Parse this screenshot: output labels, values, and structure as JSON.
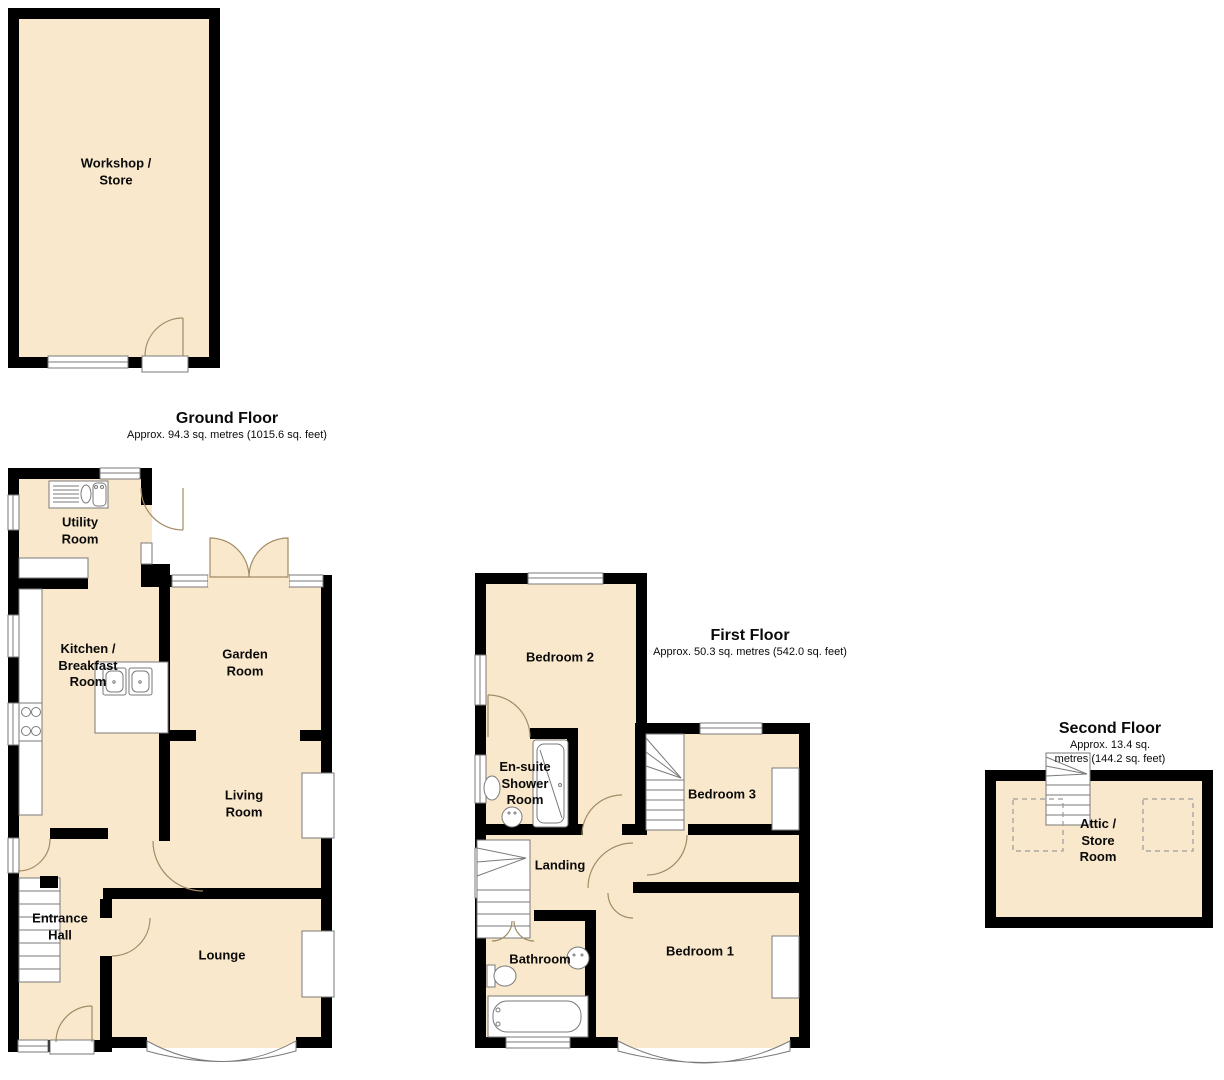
{
  "colors": {
    "room_fill": "#fae8cc",
    "wall": "#000000",
    "door_arc": "#a18c66",
    "fixture_line": "#7a7a7a",
    "dashed_line": "#9a9a9a",
    "label_color": "#0a0a0a"
  },
  "floors": [
    {
      "id": "ground",
      "title": "Ground Floor",
      "area": "Approx. 94.3 sq. metres (1015.6 sq. feet)",
      "rooms": [
        {
          "name": "Workshop /\nStore"
        },
        {
          "name": "Utility\nRoom"
        },
        {
          "name": "Kitchen /\nBreakfast\nRoom"
        },
        {
          "name": "Garden\nRoom"
        },
        {
          "name": "Living\nRoom"
        },
        {
          "name": "Entrance\nHall"
        },
        {
          "name": "Lounge"
        }
      ]
    },
    {
      "id": "first",
      "title": "First Floor",
      "area": "Approx. 50.3 sq. metres (542.0 sq. feet)",
      "rooms": [
        {
          "name": "Bedroom 2"
        },
        {
          "name": "En-suite\nShower\nRoom"
        },
        {
          "name": "Landing"
        },
        {
          "name": "Bedroom 3"
        },
        {
          "name": "Bathroom"
        },
        {
          "name": "Bedroom 1"
        }
      ]
    },
    {
      "id": "second",
      "title": "Second Floor",
      "area": "Approx. 13.4 sq. metres (144.2 sq. feet)",
      "rooms": [
        {
          "name": "Attic /\nStore\nRoom"
        }
      ]
    }
  ]
}
